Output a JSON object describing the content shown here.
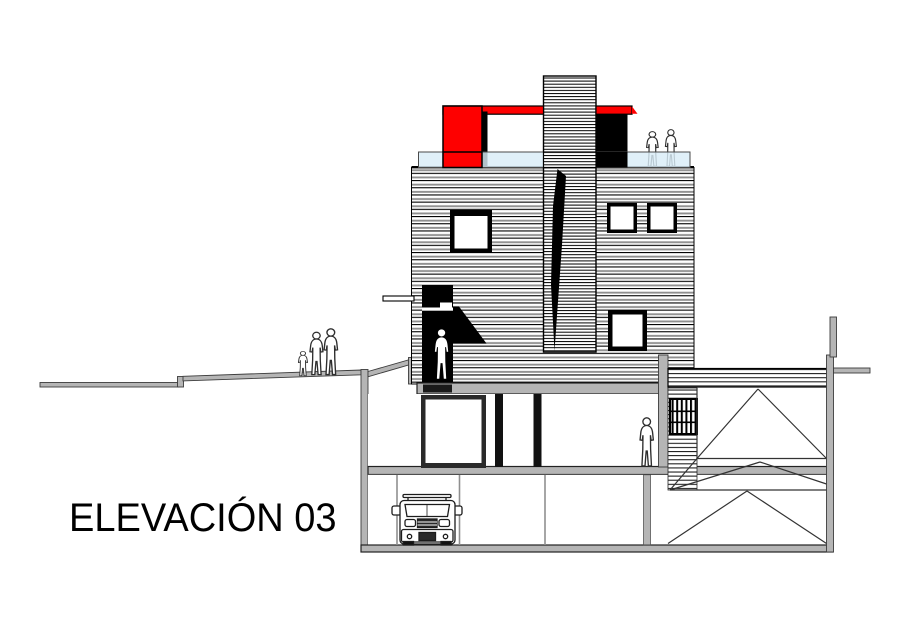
{
  "drawing": {
    "title": "ELEVACIÓN 03"
  },
  "colors": {
    "accent_red": "#fe0000",
    "glass_blue": "#d9edf8",
    "wall_gray": "#b5b5b5",
    "ink_black": "#000000",
    "paper_white": "#ffffff"
  },
  "icons": {
    "pedestrians": "three-people-walking",
    "roof_people": "two-people-on-terrace",
    "door_person": "person-in-doorway",
    "interior_person": "person-standing",
    "vehicle": "suv-front-view"
  }
}
